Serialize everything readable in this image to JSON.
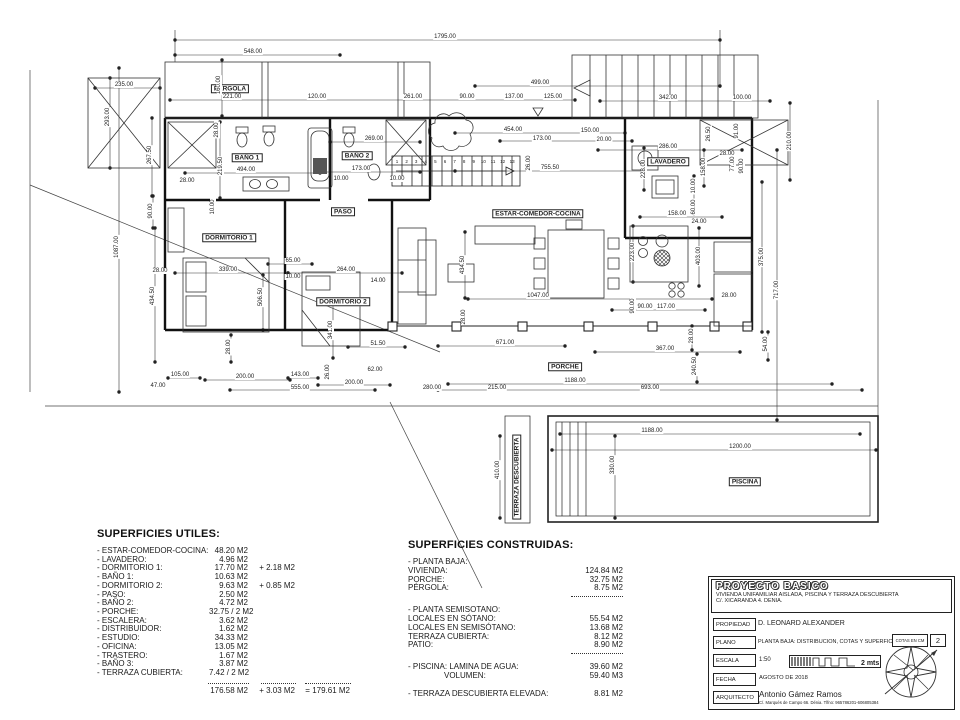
{
  "plan": {
    "rooms": [
      {
        "label": "PÉRGOLA",
        "x": 230,
        "y": 89
      },
      {
        "label": "BAÑO 1",
        "x": 247,
        "y": 158
      },
      {
        "label": "BAÑO 2",
        "x": 357,
        "y": 156
      },
      {
        "label": "PASO",
        "x": 343,
        "y": 212
      },
      {
        "label": "ESTAR-COMEDOR-COCINA",
        "x": 538,
        "y": 214
      },
      {
        "label": "LAVADERO",
        "x": 668,
        "y": 162
      },
      {
        "label": "DORMITORIO 1",
        "x": 229,
        "y": 238
      },
      {
        "label": "DORMITORIO 2",
        "x": 343,
        "y": 302
      },
      {
        "label": "PORCHE",
        "x": 565,
        "y": 367
      },
      {
        "label": "PISCINA",
        "x": 745,
        "y": 482
      },
      {
        "label": "TERRAZA DESCUBIERTA",
        "x": 517,
        "y": 477,
        "rot": 1
      }
    ],
    "stairs": {
      "x0": 397,
      "y": 162,
      "step": 9.6,
      "numbers": [
        "1",
        "2",
        "3",
        "4",
        "5",
        "6",
        "7",
        "8",
        "9",
        "10",
        "11",
        "12",
        "13"
      ]
    },
    "dims": [
      {
        "t": "1795.00",
        "x": 445,
        "y": 37
      },
      {
        "t": "548.00",
        "x": 253,
        "y": 52
      },
      {
        "t": "235.00",
        "x": 124,
        "y": 85
      },
      {
        "t": "293.00",
        "x": 108,
        "y": 117,
        "r": 1
      },
      {
        "t": "160.00",
        "x": 219,
        "y": 85,
        "r": 1
      },
      {
        "t": "221.00",
        "x": 232,
        "y": 97
      },
      {
        "t": "120.00",
        "x": 317,
        "y": 97
      },
      {
        "t": "261.00",
        "x": 413,
        "y": 97
      },
      {
        "t": "90.00",
        "x": 467,
        "y": 97
      },
      {
        "t": "137.00",
        "x": 514,
        "y": 97
      },
      {
        "t": "125.00",
        "x": 553,
        "y": 97
      },
      {
        "t": "499.00",
        "x": 540,
        "y": 83
      },
      {
        "t": "342.00",
        "x": 668,
        "y": 98
      },
      {
        "t": "100.00",
        "x": 742,
        "y": 98
      },
      {
        "t": "267.50",
        "x": 150,
        "y": 155,
        "r": 1
      },
      {
        "t": "1087.00",
        "x": 117,
        "y": 247,
        "r": 1
      },
      {
        "t": "28.00",
        "x": 217,
        "y": 130,
        "r": 1
      },
      {
        "t": "219.50",
        "x": 221,
        "y": 166,
        "r": 1
      },
      {
        "t": "269.00",
        "x": 374,
        "y": 139
      },
      {
        "t": "494.00",
        "x": 246,
        "y": 170
      },
      {
        "t": "173.00",
        "x": 361,
        "y": 169
      },
      {
        "t": "10.00",
        "x": 341,
        "y": 179
      },
      {
        "t": "10.00",
        "x": 397,
        "y": 179
      },
      {
        "t": "28.00",
        "x": 187,
        "y": 181
      },
      {
        "t": "90.00",
        "x": 151,
        "y": 211,
        "r": 1
      },
      {
        "t": "10.00",
        "x": 213,
        "y": 207,
        "r": 1
      },
      {
        "t": "28.00",
        "x": 160,
        "y": 271
      },
      {
        "t": "434.50",
        "x": 153,
        "y": 296,
        "r": 1
      },
      {
        "t": "454.00",
        "x": 513,
        "y": 130
      },
      {
        "t": "173.00",
        "x": 542,
        "y": 139
      },
      {
        "t": "150.00",
        "x": 590,
        "y": 131
      },
      {
        "t": "20.00",
        "x": 604,
        "y": 140
      },
      {
        "t": "755.50",
        "x": 550,
        "y": 168
      },
      {
        "t": "26.00",
        "x": 529,
        "y": 163,
        "r": 1
      },
      {
        "t": "286.00",
        "x": 668,
        "y": 147
      },
      {
        "t": "28.00",
        "x": 727,
        "y": 154
      },
      {
        "t": "26.50",
        "x": 709,
        "y": 134,
        "r": 1
      },
      {
        "t": "91.00",
        "x": 737,
        "y": 131,
        "r": 1
      },
      {
        "t": "210.00",
        "x": 790,
        "y": 141,
        "r": 1
      },
      {
        "t": "228.00",
        "x": 644,
        "y": 169,
        "r": 1
      },
      {
        "t": "158.00",
        "x": 704,
        "y": 167,
        "r": 1
      },
      {
        "t": "77.00",
        "x": 733,
        "y": 164,
        "r": 1
      },
      {
        "t": "90.00",
        "x": 742,
        "y": 166,
        "r": 1
      },
      {
        "t": "10.00",
        "x": 694,
        "y": 186,
        "r": 1
      },
      {
        "t": "60.00",
        "x": 694,
        "y": 207,
        "r": 1
      },
      {
        "t": "158.00",
        "x": 677,
        "y": 214
      },
      {
        "t": "24.00",
        "x": 699,
        "y": 222
      },
      {
        "t": "223.00",
        "x": 633,
        "y": 252,
        "r": 1
      },
      {
        "t": "403.00",
        "x": 699,
        "y": 256,
        "r": 1
      },
      {
        "t": "375.00",
        "x": 762,
        "y": 257,
        "r": 1
      },
      {
        "t": "717.00",
        "x": 777,
        "y": 290,
        "r": 1
      },
      {
        "t": "339.00",
        "x": 228,
        "y": 270
      },
      {
        "t": "506.50",
        "x": 261,
        "y": 297,
        "r": 1
      },
      {
        "t": "65.00",
        "x": 293,
        "y": 261
      },
      {
        "t": "264.00",
        "x": 346,
        "y": 270
      },
      {
        "t": "10.00",
        "x": 293,
        "y": 277
      },
      {
        "t": "14.00",
        "x": 378,
        "y": 281
      },
      {
        "t": "341.00",
        "x": 331,
        "y": 330,
        "r": 1
      },
      {
        "t": "51.50",
        "x": 378,
        "y": 344
      },
      {
        "t": "28.00",
        "x": 229,
        "y": 347,
        "r": 1
      },
      {
        "t": "434.50",
        "x": 463,
        "y": 265,
        "r": 1
      },
      {
        "t": "1047.00",
        "x": 538,
        "y": 296
      },
      {
        "t": "28.00",
        "x": 464,
        "y": 317,
        "r": 1
      },
      {
        "t": "117.00",
        "x": 666,
        "y": 307
      },
      {
        "t": "90.00",
        "x": 645,
        "y": 307
      },
      {
        "t": "90.00",
        "x": 633,
        "y": 306,
        "r": 1
      },
      {
        "t": "28.00",
        "x": 729,
        "y": 296
      },
      {
        "t": "28.00",
        "x": 692,
        "y": 336,
        "r": 1
      },
      {
        "t": "54.00",
        "x": 766,
        "y": 344,
        "r": 1
      },
      {
        "t": "240.50",
        "x": 695,
        "y": 366,
        "r": 1
      },
      {
        "t": "671.00",
        "x": 505,
        "y": 343
      },
      {
        "t": "367.00",
        "x": 665,
        "y": 349
      },
      {
        "t": "62.00",
        "x": 375,
        "y": 370
      },
      {
        "t": "26.00",
        "x": 328,
        "y": 372,
        "r": 1
      },
      {
        "t": "105.00",
        "x": 180,
        "y": 375
      },
      {
        "t": "47.00",
        "x": 158,
        "y": 386
      },
      {
        "t": "200.00",
        "x": 245,
        "y": 377
      },
      {
        "t": "143.00",
        "x": 300,
        "y": 375
      },
      {
        "t": "555.00",
        "x": 300,
        "y": 388
      },
      {
        "t": "200.00",
        "x": 354,
        "y": 383
      },
      {
        "t": "280.00",
        "x": 432,
        "y": 388
      },
      {
        "t": "1188.00",
        "x": 575,
        "y": 381
      },
      {
        "t": "215.00",
        "x": 497,
        "y": 388
      },
      {
        "t": "693.00",
        "x": 650,
        "y": 388
      },
      {
        "t": "1188.00",
        "x": 652,
        "y": 431
      },
      {
        "t": "1200.00",
        "x": 740,
        "y": 447
      },
      {
        "t": "330.00",
        "x": 613,
        "y": 465,
        "r": 1
      },
      {
        "t": "410.00",
        "x": 498,
        "y": 470,
        "r": 1
      }
    ]
  },
  "superficies_utiles": {
    "title": "SUPERFICIES UTILES:",
    "rows": [
      {
        "label": "- ESTAR-COMEDOR-COCINA:",
        "value": "48.20 M2",
        "extra": ""
      },
      {
        "label": "- LAVADERO:",
        "value": "4.96 M2",
        "extra": ""
      },
      {
        "label": "- DORMITORIO 1:",
        "value": "17.70 M2",
        "extra": "+ 2.18 M2"
      },
      {
        "label": "- BAÑO 1:",
        "value": "10.63 M2",
        "extra": ""
      },
      {
        "label": "- DORMITORIO 2:",
        "value": "9.63 M2",
        "extra": "+ 0.85 M2"
      },
      {
        "label": "- PASO:",
        "value": "2.50 M2",
        "extra": ""
      },
      {
        "label": "- BAÑO 2:",
        "value": "4.72 M2",
        "extra": ""
      },
      {
        "label": "- PORCHE:",
        "value": "32.75 / 2 M2",
        "extra": ""
      },
      {
        "label": "- ESCALERA:",
        "value": "3.62 M2",
        "extra": ""
      },
      {
        "label": "- DISTRIBUIDOR:",
        "value": "1.62 M2",
        "extra": ""
      },
      {
        "label": "- ESTUDIO:",
        "value": "34.33 M2",
        "extra": ""
      },
      {
        "label": "- OFICINA:",
        "value": "13.05 M2",
        "extra": ""
      },
      {
        "label": "- TRASTERO:",
        "value": "1.67 M2",
        "extra": ""
      },
      {
        "label": "- BAÑO 3:",
        "value": "3.87 M2",
        "extra": ""
      },
      {
        "label": "- TERRAZA CUBIERTA:",
        "value": "7.42 / 2 M2",
        "extra": ""
      }
    ],
    "totals": {
      "main": "176.58 M2",
      "extra": "+ 3.03 M2",
      "result": "= 179.61 M2"
    }
  },
  "superficies_construidas": {
    "title": "SUPERFICIES CONSTRUIDAS:",
    "groups": [
      {
        "header": "- PLANTA BAJA:",
        "rows": [
          {
            "label": "VIVIENDA:",
            "value": "124.84 M2"
          },
          {
            "label": "PORCHE:",
            "value": "32.75 M2"
          },
          {
            "label": "PÉRGOLA:",
            "value": "8.75 M2"
          }
        ],
        "divider": true
      },
      {
        "header": "- PLANTA SEMISOTANO:",
        "rows": [
          {
            "label": "LOCALES EN SÓTANO:",
            "value": "55.54 M2"
          },
          {
            "label": "LOCALES EN SEMISÓTANO:",
            "value": "13.68 M2"
          },
          {
            "label": "TERRAZA CUBIERTA:",
            "value": "8.12 M2"
          },
          {
            "label": "PATIO:",
            "value": "8.90 M2"
          }
        ],
        "divider": true
      },
      {
        "header": "",
        "rows": [
          {
            "label": "- PISCINA: LAMINA DE AGUA:",
            "value": "39.60 M2"
          },
          {
            "label": "VOLUMEN:",
            "value": "59.40 M3",
            "indent": true
          }
        ],
        "divider": false
      },
      {
        "header": "",
        "rows": [
          {
            "label": "- TERRAZA DESCUBIERTA ELEVADA:",
            "value": "8.81 M2"
          }
        ],
        "divider": false
      }
    ]
  },
  "title_block": {
    "title": "PROYECTO BASICO",
    "subtitle1": "VIVIENDA UNIFAMILIAR AISLADA, PISCINA Y TERRAZA DESCUBIERTA",
    "subtitle2": "C/. XICARANDA 4. DENIA.",
    "propiedad_label": "PROPIEDAD",
    "propiedad": "D. LEONARD ALEXANDER",
    "plano_label": "PLANO",
    "plano": "PLANTA BAJA: DISTRIBUCION, COTAS Y SUPERFICIES",
    "cotas": "COTAS EN CM",
    "sheet": "2",
    "escala_label": "ESCALA",
    "escala": "1:50",
    "escala_unit": "2 mts",
    "fecha_label": "FECHA",
    "fecha": "AGOSTO DE 2018",
    "arquitecto_label": "ARQUITECTO",
    "arquitecto": "Antonio Gámez Ramos",
    "arquitecto_info": "C/. Marqués de Campo 66. Dénia. Tlfno: 965786201-606805384"
  }
}
